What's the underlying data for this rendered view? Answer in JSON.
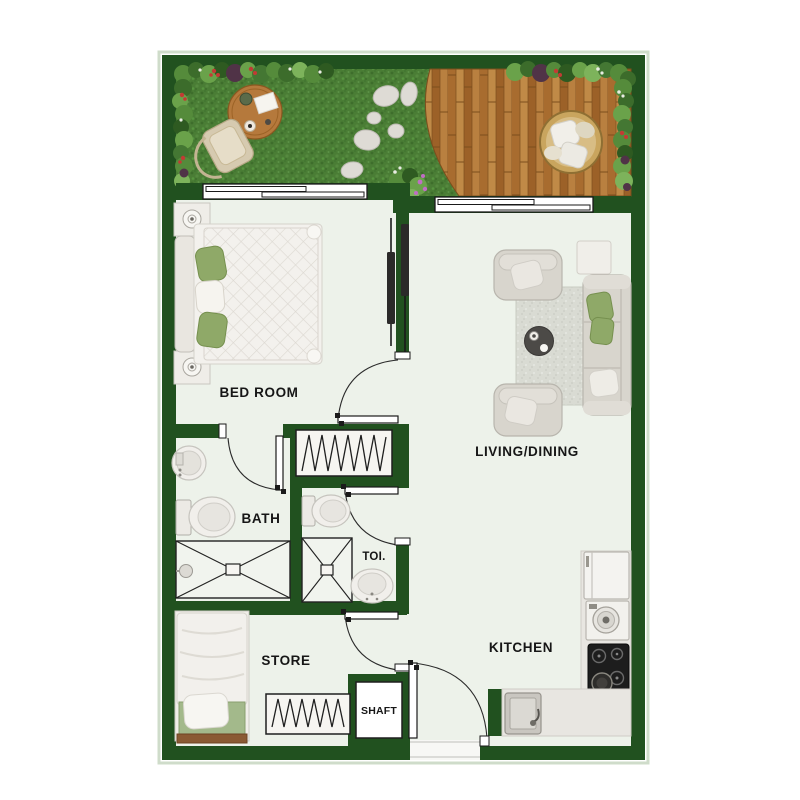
{
  "plan": {
    "type": "apartment-floor-plan",
    "rooms": {
      "bedroom": {
        "label": "BED ROOM"
      },
      "bath": {
        "label": "BATH"
      },
      "toilet": {
        "label": "TOI."
      },
      "living_dining": {
        "label": "LIVING/DINING"
      },
      "store": {
        "label": "STORE"
      },
      "shaft": {
        "label": "SHAFT"
      },
      "kitchen": {
        "label": "KITCHEN"
      }
    },
    "outdoor_features": [
      "lawn",
      "wood-deck",
      "flower-border",
      "stepping-stones",
      "garden-table",
      "garden-chair",
      "round-daybed",
      "flower-bush"
    ],
    "icons": [
      "double-bed-icon",
      "nightstand-icon",
      "single-bed-icon",
      "sofa-icon",
      "armchair-icon",
      "side-table-icon",
      "coffee-table-icon",
      "rug-icon",
      "wardrobe-icon",
      "washbasin-icon",
      "toilet-icon",
      "shower-icon",
      "refrigerator-icon",
      "washing-machine-icon",
      "cooktop-icon",
      "kitchen-sink-icon",
      "window-icon",
      "door-icon",
      "sliding-door-icon",
      "entrance-door-icon",
      "garden-table-icon",
      "garden-chair-icon",
      "garden-daybed-icon",
      "stepping-stones-icon"
    ],
    "colors": {
      "wall": "#21511f",
      "floor": "#edf2ea",
      "grass": "#4a7d35",
      "deck_wood": "#b3763a",
      "furniture": "#d8d5cd",
      "accent_pillow": "#8fa968",
      "rug": "#d9dbd3",
      "counter": "#e8e6e1",
      "cooktop": "#1d1d1d",
      "label_text": "#161616"
    }
  }
}
